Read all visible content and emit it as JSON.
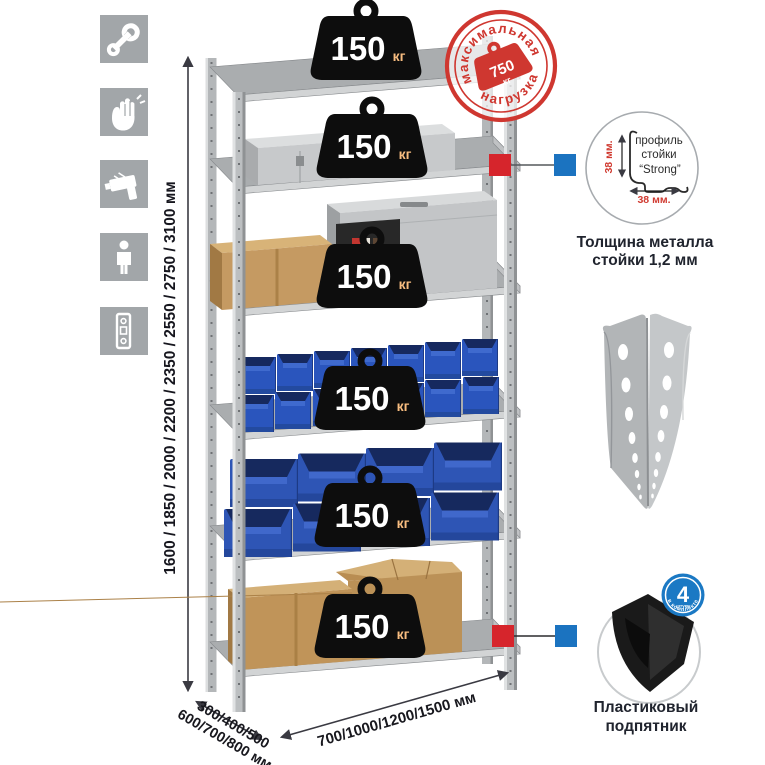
{
  "left_icons": {
    "items": [
      {
        "name": "wrench"
      },
      {
        "name": "gloves"
      },
      {
        "name": "drill"
      },
      {
        "name": "person-height"
      },
      {
        "name": "spirit-level"
      }
    ]
  },
  "height_dimension": {
    "label": "1600 / 1850 / 2000 / 2200 / 2350 / 2550 / 2750 / 3100 мм"
  },
  "rack": {
    "shelves": [
      {
        "load": "150",
        "unit": "кг"
      },
      {
        "load": "150",
        "unit": "кг"
      },
      {
        "load": "150",
        "unit": "кг"
      },
      {
        "load": "150",
        "unit": "кг"
      },
      {
        "load": "150",
        "unit": "кг"
      },
      {
        "load": "150",
        "unit": "кг"
      }
    ]
  },
  "max_load_stamp": {
    "arc_top": "максимальная",
    "arc_bottom": "нагрузка",
    "value": "750",
    "unit": "кг"
  },
  "profile_detail": {
    "line1": "профиль",
    "line2": "стойки",
    "line3": "“Strong”",
    "dim_vertical": "38 мм.",
    "dim_horizontal": "38 мм.",
    "caption_line1": "Толщина металла",
    "caption_line2": "стойки 1,2 мм"
  },
  "foot_detail": {
    "badge_value": "4",
    "badge_small": "штуки",
    "badge_arc": "в комплекте",
    "caption_line1": "Пластиковый",
    "caption_line2": "подпятник"
  },
  "depth_dimension": {
    "line1": "300/400/500",
    "line2": "600/700/800 мм"
  },
  "width_dimension": {
    "label": "700/1000/1200/1500 мм"
  },
  "colors": {
    "accent_red": "#cf3730",
    "marker_red": "#d6252c",
    "marker_blue": "#1b73c0",
    "badge_blue": "#1b79c4",
    "bin_blue": "#2e55b5",
    "metal_gray": "#b9bcbe",
    "weight_black": "#0d0d0d",
    "kraft": "#c59a62",
    "text_dark": "#20242e"
  }
}
